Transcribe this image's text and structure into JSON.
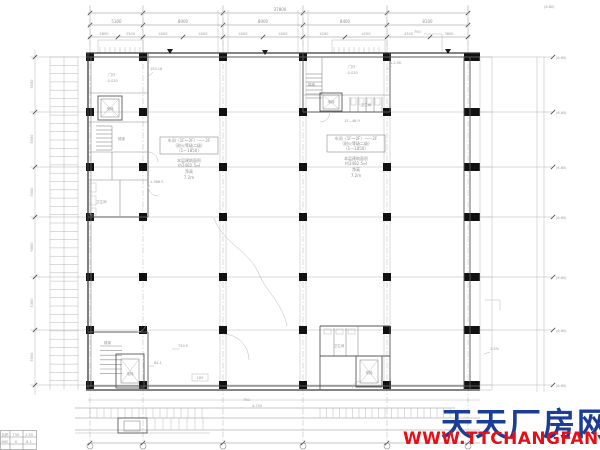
{
  "watermark": {
    "site_name": "天天厂房网",
    "site_url": "WWW.TTCHANGFANG.COM",
    "name_color": "#1c3d96",
    "url_color": "#e60e17"
  },
  "dims": {
    "top_total": "37800",
    "top_bays": [
      "5300",
      "8000",
      "8000",
      "8400",
      "8100"
    ],
    "top_sub": [
      "2800",
      "2500",
      "4000",
      "4000",
      "4000",
      "4000",
      "4200",
      "4200",
      "4300",
      "3800"
    ],
    "left_bays": [
      "5500",
      "5500",
      "5000",
      "6000",
      "5300",
      "5500"
    ],
    "right_levels": [
      "(6.60)",
      "(6.60)",
      "(6.60)",
      "(6.60)",
      "(6.60)",
      "(6.60)",
      "(6.60)"
    ]
  },
  "rooms": {
    "lobby": "门厅",
    "lobby_level": "-0.020",
    "stair": "楼梯",
    "elevator": "电梯",
    "toilet": "卫生间",
    "room_area": "1F—48.9"
  },
  "hall_left": {
    "box_line1": "车间（1F～2F）——2F",
    "box_line2": "（耐火等级二级）",
    "box_line3": "（1—1850）",
    "note1": "本层建筑面积",
    "note2": "约2482.5㎡",
    "note3": "净高",
    "note4": "7.2m"
  },
  "hall_right": {
    "box_line1": "车间（1F～2F）——2F",
    "box_line2": "（耐火等级二级）",
    "box_line3": "（1—1850）",
    "note1": "本层建筑面积",
    "note2": "约2482.5㎡",
    "note3": "净高",
    "note4": "7.2m"
  },
  "leaders": {
    "a": "150.18",
    "b": "1-988.5",
    "c": "1-2.0K",
    "d": "750",
    "e": "750.5",
    "f": "84.1",
    "g": "180",
    "h": "1.5%",
    "i": "(6.60)",
    "dock_note1": "750",
    "dock_note2": "4-750"
  },
  "legend_table": {
    "r1c1": "名称",
    "r1c2": "T50",
    "r1c3": "1-50",
    "r2c1": "8HE",
    "r2c2": "6",
    "r2c3": "8-1"
  }
}
